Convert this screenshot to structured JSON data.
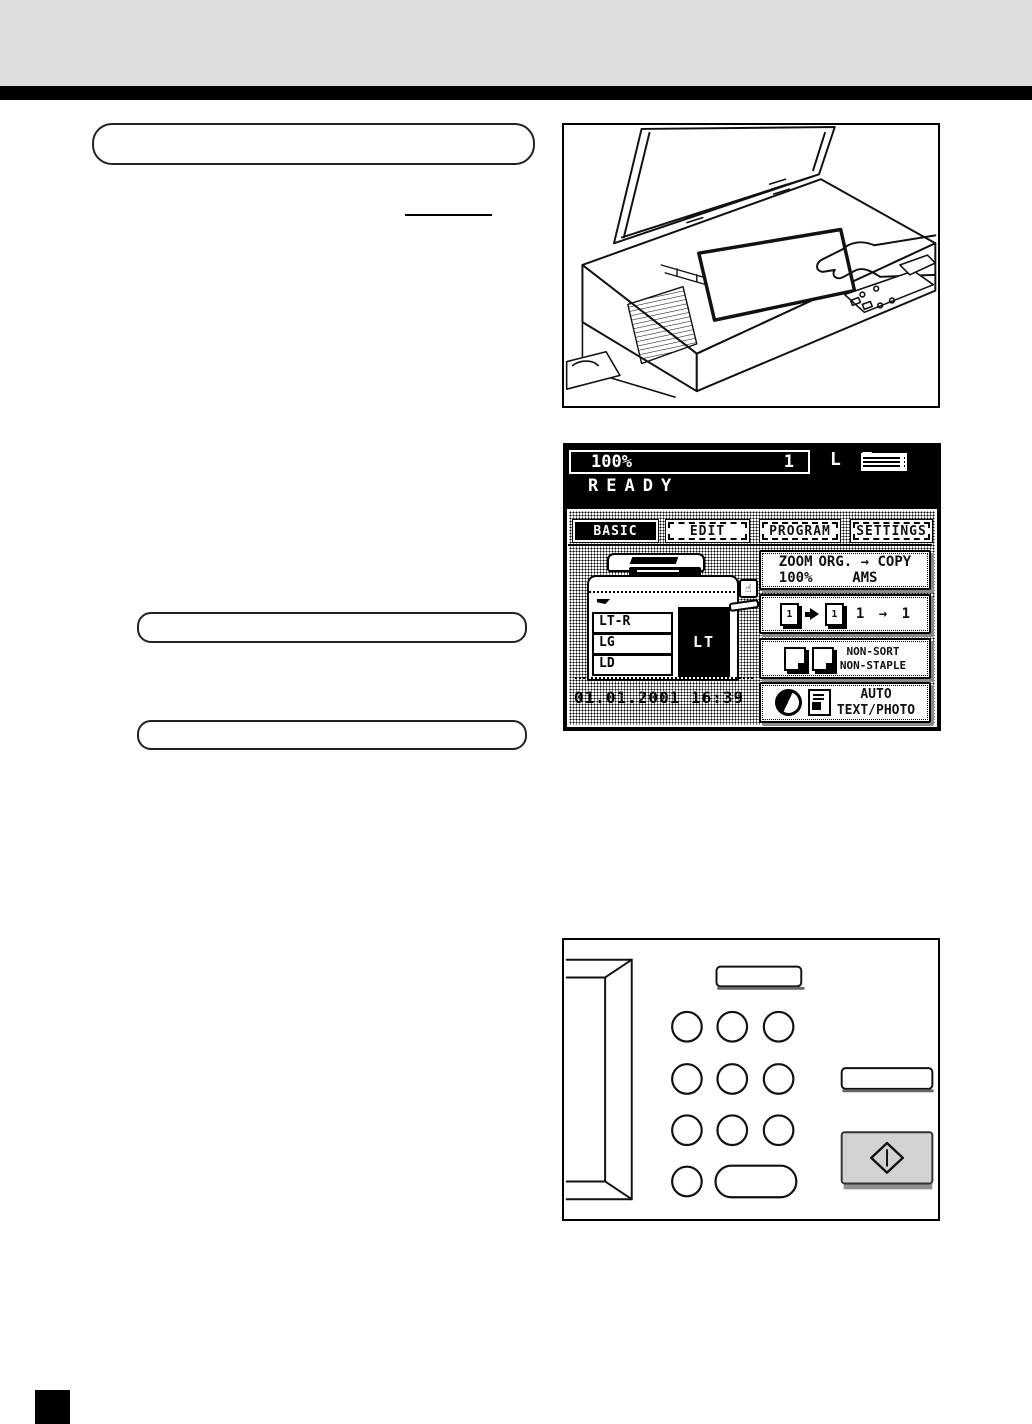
{
  "colors": {
    "header_band": "#dcdcdc",
    "rule": "#000000",
    "start_button": "#d2d2d2",
    "lcd_background": "#000000"
  },
  "lcd": {
    "status_bar": {
      "zoom": "100%",
      "count": "1",
      "paper": "L T"
    },
    "ready": "READY",
    "tabs": [
      {
        "label": "BASIC",
        "selected": true
      },
      {
        "label": "EDIT",
        "selected": false
      },
      {
        "label": "PROGRAM",
        "selected": false
      },
      {
        "label": "SETTINGS",
        "selected": false
      }
    ],
    "machine": {
      "drawers": [
        "LT-R",
        "LG",
        "LD"
      ],
      "selected": "LT",
      "hand_glyph": "☝"
    },
    "datetime": "01.01.2001 16:39",
    "buttons": {
      "zoom": {
        "label": "ZOOM",
        "value": "100%"
      },
      "orig_copy": {
        "label": "ORG. → COPY",
        "value": "AMS"
      },
      "simplex": {
        "page_left": "1",
        "page_right": "1",
        "label": "1 → 1"
      },
      "finisher": {
        "line1": "NON-SORT",
        "line2": "NON-STAPLE"
      },
      "image_mode": {
        "line1": "AUTO",
        "line2": "TEXT/PHOTO"
      }
    }
  }
}
